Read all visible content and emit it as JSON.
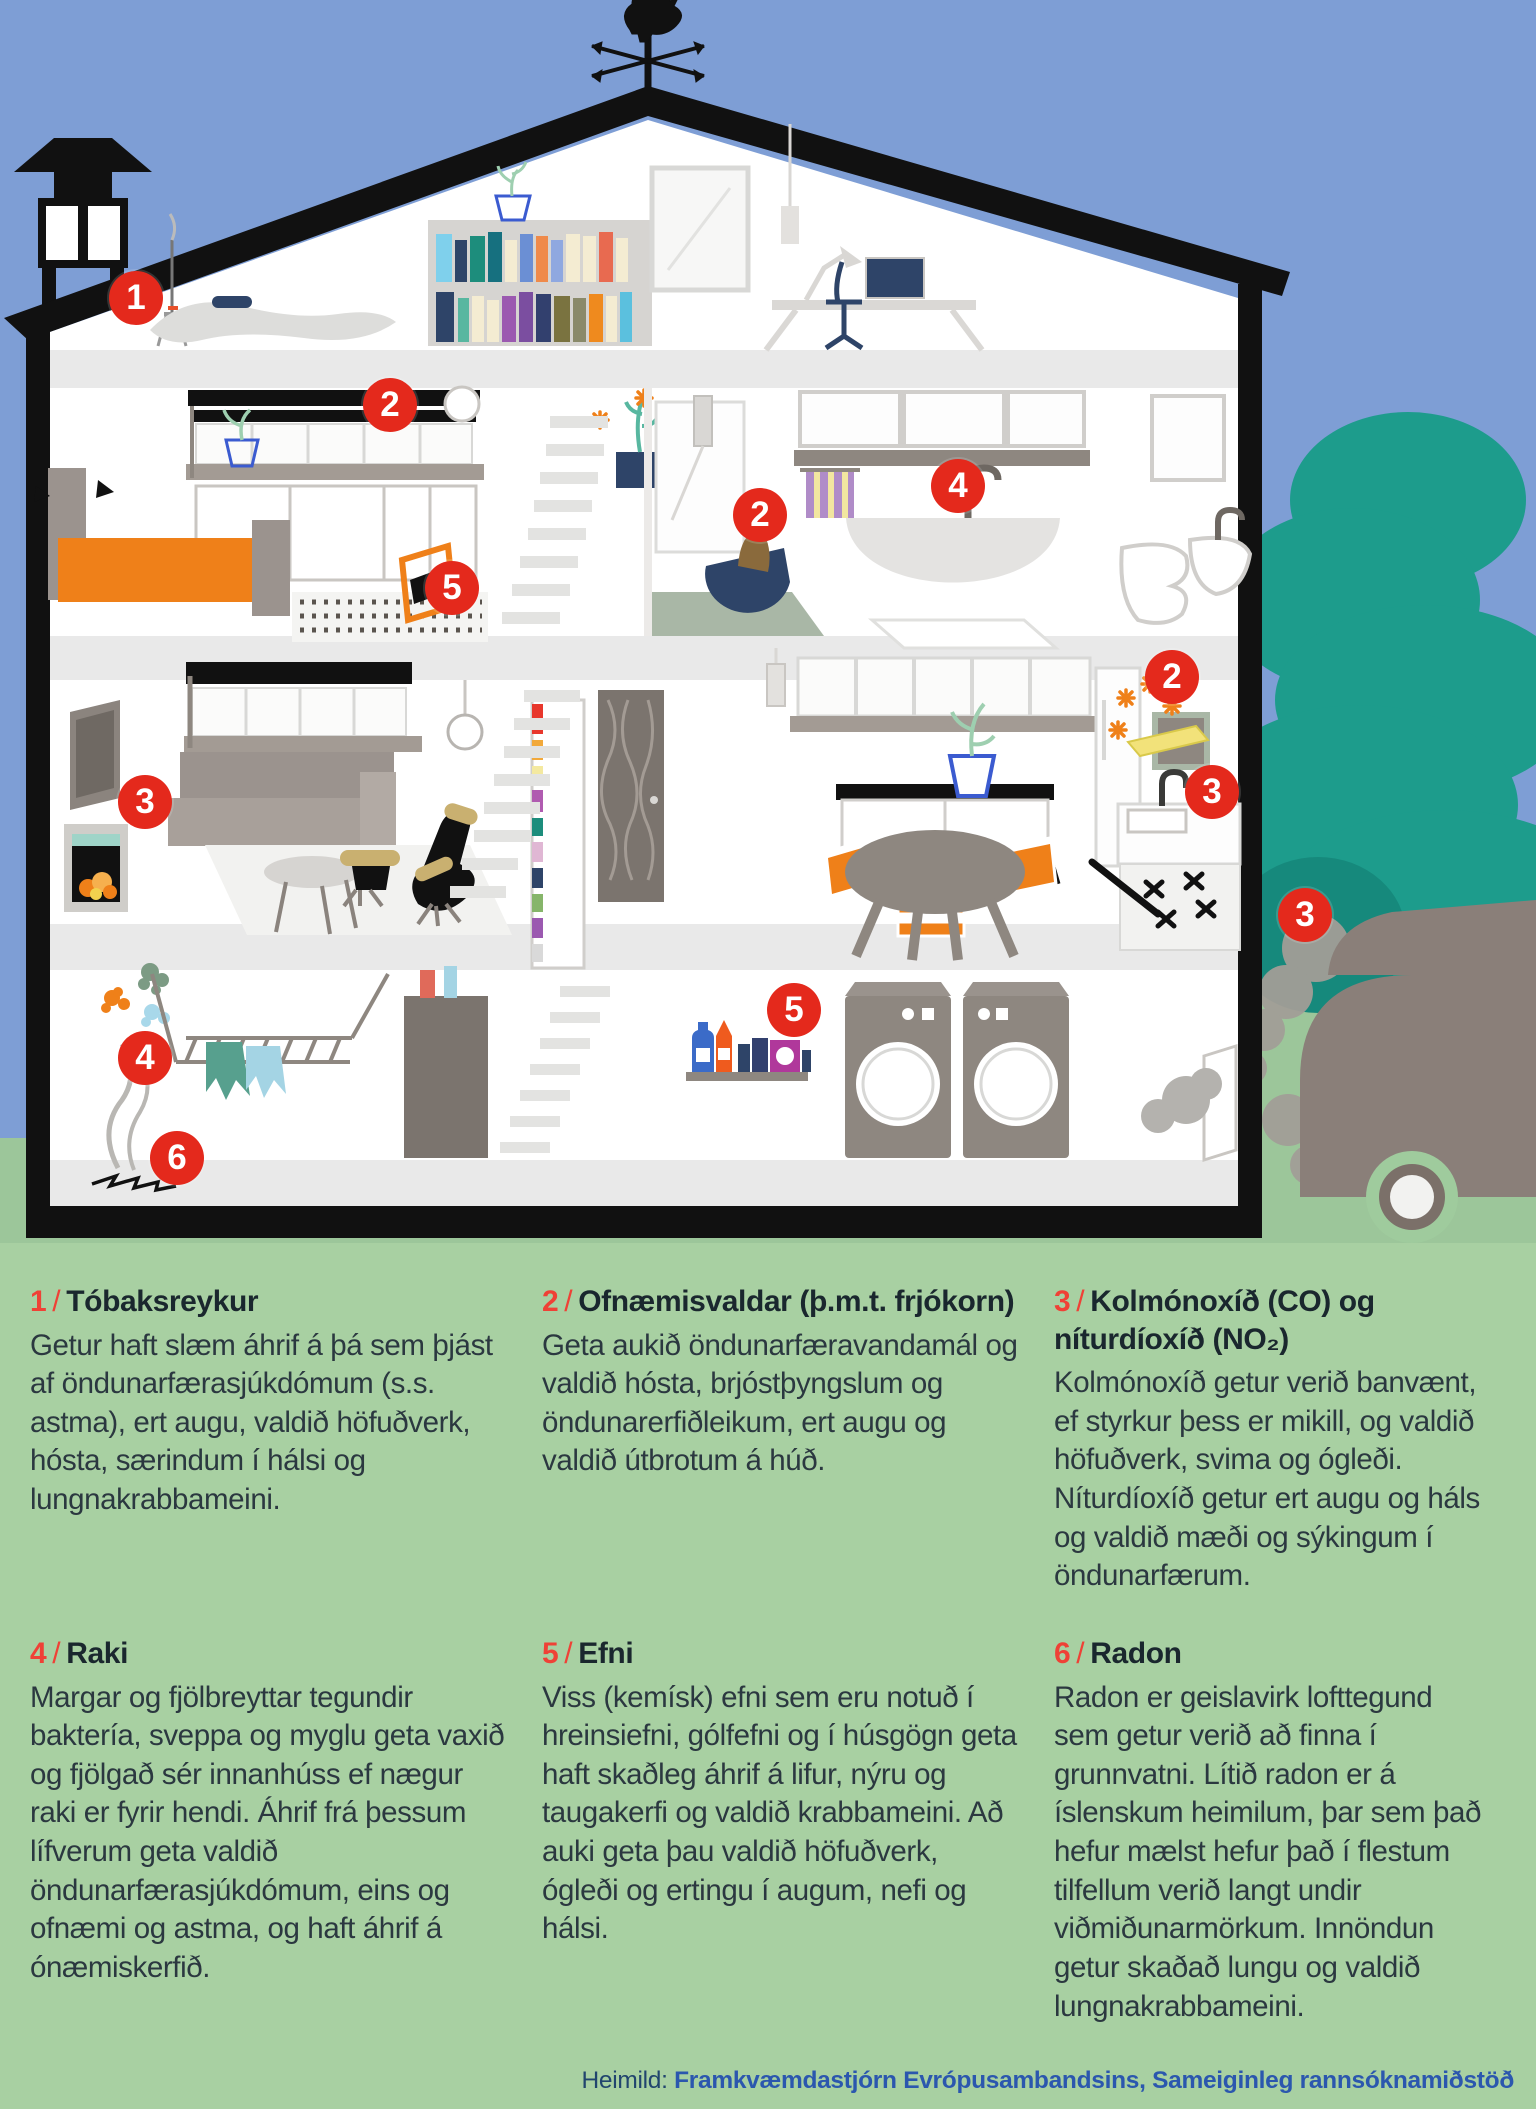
{
  "ui": {
    "slash": "/"
  },
  "colors": {
    "badge_red": "#e4291c",
    "number_red": "#ef4136",
    "panel_green": "#a8d0a2",
    "grass_green": "#9cc69a",
    "sky_blue": "#7e9ed5",
    "tree_teal": "#1d9c8c",
    "accent_orange": "#ef8019",
    "accent_navy": "#2e4468"
  },
  "hazards": [
    {
      "num": "1",
      "title": "Tóbaksreykur",
      "body": "Getur haft slæm áhrif á þá sem þjást af öndunarfærasjúkdómum (s.s. astma),  ert augu, valdið höfuðverk, hósta, særindum í hálsi og lungnakrabbameini."
    },
    {
      "num": "2",
      "title": "Ofnæmisvaldar (þ.m.t. frjókorn)",
      "body": "Geta aukið öndunarfæravandamál og valdið hósta, brjóstþyngslum og öndunarerfiðleikum, ert augu og valdið útbrotum á húð."
    },
    {
      "num": "3",
      "title": "Kolmónoxíð (CO) og níturdíoxíð (NO₂)",
      "body": "Kolmónoxíð getur verið banvænt, ef styrkur þess er mikill, og valdið höfuðverk, svima og ógleði. Níturdíoxíð getur ert augu og háls og valdið mæði og sýkingum í öndunarfærum."
    },
    {
      "num": "4",
      "title": "Raki",
      "body": "Margar og fjölbreyttar tegundir baktería, sveppa og myglu geta vaxið og fjölgað sér innanhúss ef nægur raki er fyrir hendi. Áhrif frá þessum lífverum geta valdið öndunarfærasjúkdómum, eins og ofnæmi og astma, og haft áhrif á ónæmiskerfið."
    },
    {
      "num": "5",
      "title": "Efni",
      "body": "Viss (kemísk) efni sem eru notuð í hreinsiefni, gólfefni og í húsgögn geta haft skaðleg áhrif á lifur, nýru og taugakerfi og valdið krabbameini. Að auki geta þau valdið höfuðverk, ógleði og ertingu í augum, nefi og hálsi."
    },
    {
      "num": "6",
      "title": "Radon",
      "body": "Radon er geislavirk lofttegund sem getur verið að finna í grunnvatni. Lítið radon er á íslenskum heimilum, þar sem það hefur mælst hefur það í flestum tilfellum verið langt undir viðmiðunarmörkum. Innöndun getur skaðað lungu og valdið lungnakrabbameini."
    }
  ],
  "markers": [
    {
      "label": "1",
      "x": 136,
      "y": 298,
      "location": "tobacco-smoke-attic"
    },
    {
      "label": "2",
      "x": 390,
      "y": 405,
      "location": "bedroom-window-pollen"
    },
    {
      "label": "5",
      "x": 452,
      "y": 588,
      "location": "bedroom-rug-chair"
    },
    {
      "label": "2",
      "x": 760,
      "y": 515,
      "location": "dog-bed"
    },
    {
      "label": "4",
      "x": 958,
      "y": 486,
      "location": "bathroom-bathtub"
    },
    {
      "label": "2",
      "x": 1172,
      "y": 677,
      "location": "kitchen-allergens"
    },
    {
      "label": "3",
      "x": 1212,
      "y": 792,
      "location": "kitchen-stove"
    },
    {
      "label": "3",
      "x": 145,
      "y": 802,
      "location": "living-room-fireplace"
    },
    {
      "label": "4",
      "x": 145,
      "y": 1058,
      "location": "basement-drying-rack"
    },
    {
      "label": "6",
      "x": 177,
      "y": 1158,
      "location": "basement-floor-crack"
    },
    {
      "label": "5",
      "x": 794,
      "y": 1010,
      "location": "basement-cleaning-products"
    },
    {
      "label": "3",
      "x": 1305,
      "y": 915,
      "location": "outdoor-car-exhaust"
    }
  ],
  "footer": {
    "label": "Heimild:",
    "source": "Framkvæmdastjórn Evrópusambandsins, Sameiginleg rannsóknamiðstöð"
  }
}
